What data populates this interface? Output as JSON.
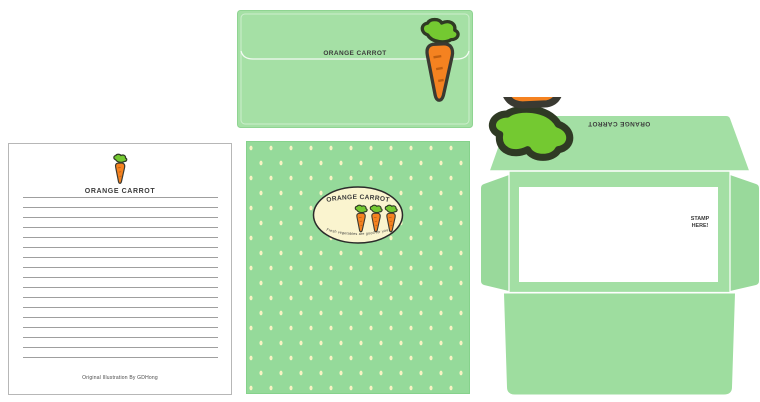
{
  "brand": {
    "title": "ORANGE CARROT",
    "tagline": "Fresh vegetables are good for you.",
    "credit": "Original Illustration By GDHong"
  },
  "envelope_front": {
    "title": "ORANGE CARROT"
  },
  "letterhead": {
    "title": "ORANGE CARROT",
    "credit": "Original Illustration By GDHong"
  },
  "dotted_paper": {
    "badge_title": "ORANGE CARROT",
    "badge_tagline": "Fresh vegetables are good for you."
  },
  "envelope_template": {
    "flap_title": "ORANGE CARROT",
    "stamp_line1": "STAMP",
    "stamp_line2": "HERE!"
  },
  "colors": {
    "envelope_green": "#a5e0a5",
    "paper_green": "#95da9a",
    "dot_cream": "#f7f3c2",
    "badge_cream": "#faf4cf",
    "carrot_orange": "#f58220",
    "leaf_green": "#74c931",
    "outline_dark": "#343a2c",
    "text_dark": "#3b3b3b"
  }
}
